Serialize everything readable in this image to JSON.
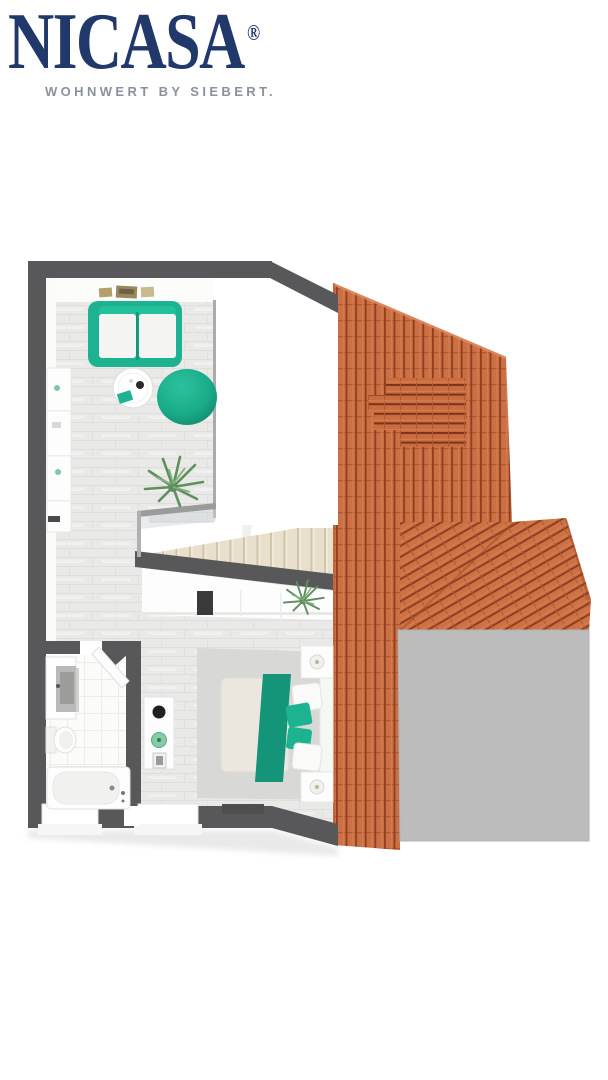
{
  "brand": {
    "name": "NICASA",
    "registered": "®",
    "tagline": "WOHNWERT BY SIEBERT."
  },
  "colors": {
    "logo_navy": "#21386b",
    "tagline_gray": "#8b919c",
    "accent_teal": "#1db391",
    "teal_dark": "#149478",
    "wall_gray": "#58585a",
    "roof_tile": "#cb7044",
    "roof_tile_dark": "#8f3e20",
    "roof_tile_light": "#d67c4e",
    "flat_roof_gray": "#bcbcbc",
    "floor_wood": "#e9e9e7",
    "rug_gray": "#d8d8d6",
    "stair_beige": "#e8dfcc",
    "bath_tile_white": "#fbfbfa",
    "mattress_beige": "#ebe7df",
    "plant_green": "#5f8f5d"
  },
  "plan": {
    "view": "3d-top-down-floor-plan",
    "rooms": [
      "living-room",
      "stairwell",
      "hallway",
      "bedroom",
      "bathroom"
    ],
    "roof_elements": [
      "tiled-roof",
      "roof-dormer",
      "hip-roof",
      "flat-roof"
    ],
    "furniture": {
      "living_room": [
        "sofa",
        "coffee-table",
        "bean-bag-chair",
        "wall-shelf",
        "wall-art",
        "potted-plant"
      ],
      "bedroom": [
        "double-bed",
        "teal-runner",
        "pillows",
        "nightstand",
        "table-lamp",
        "area-rug",
        "wardrobe",
        "console-table",
        "potted-plant"
      ],
      "bathroom": [
        "bathtub",
        "toilet",
        "vanity-sink",
        "door"
      ],
      "stairwell": [
        "staircase",
        "glass-railing"
      ]
    }
  }
}
